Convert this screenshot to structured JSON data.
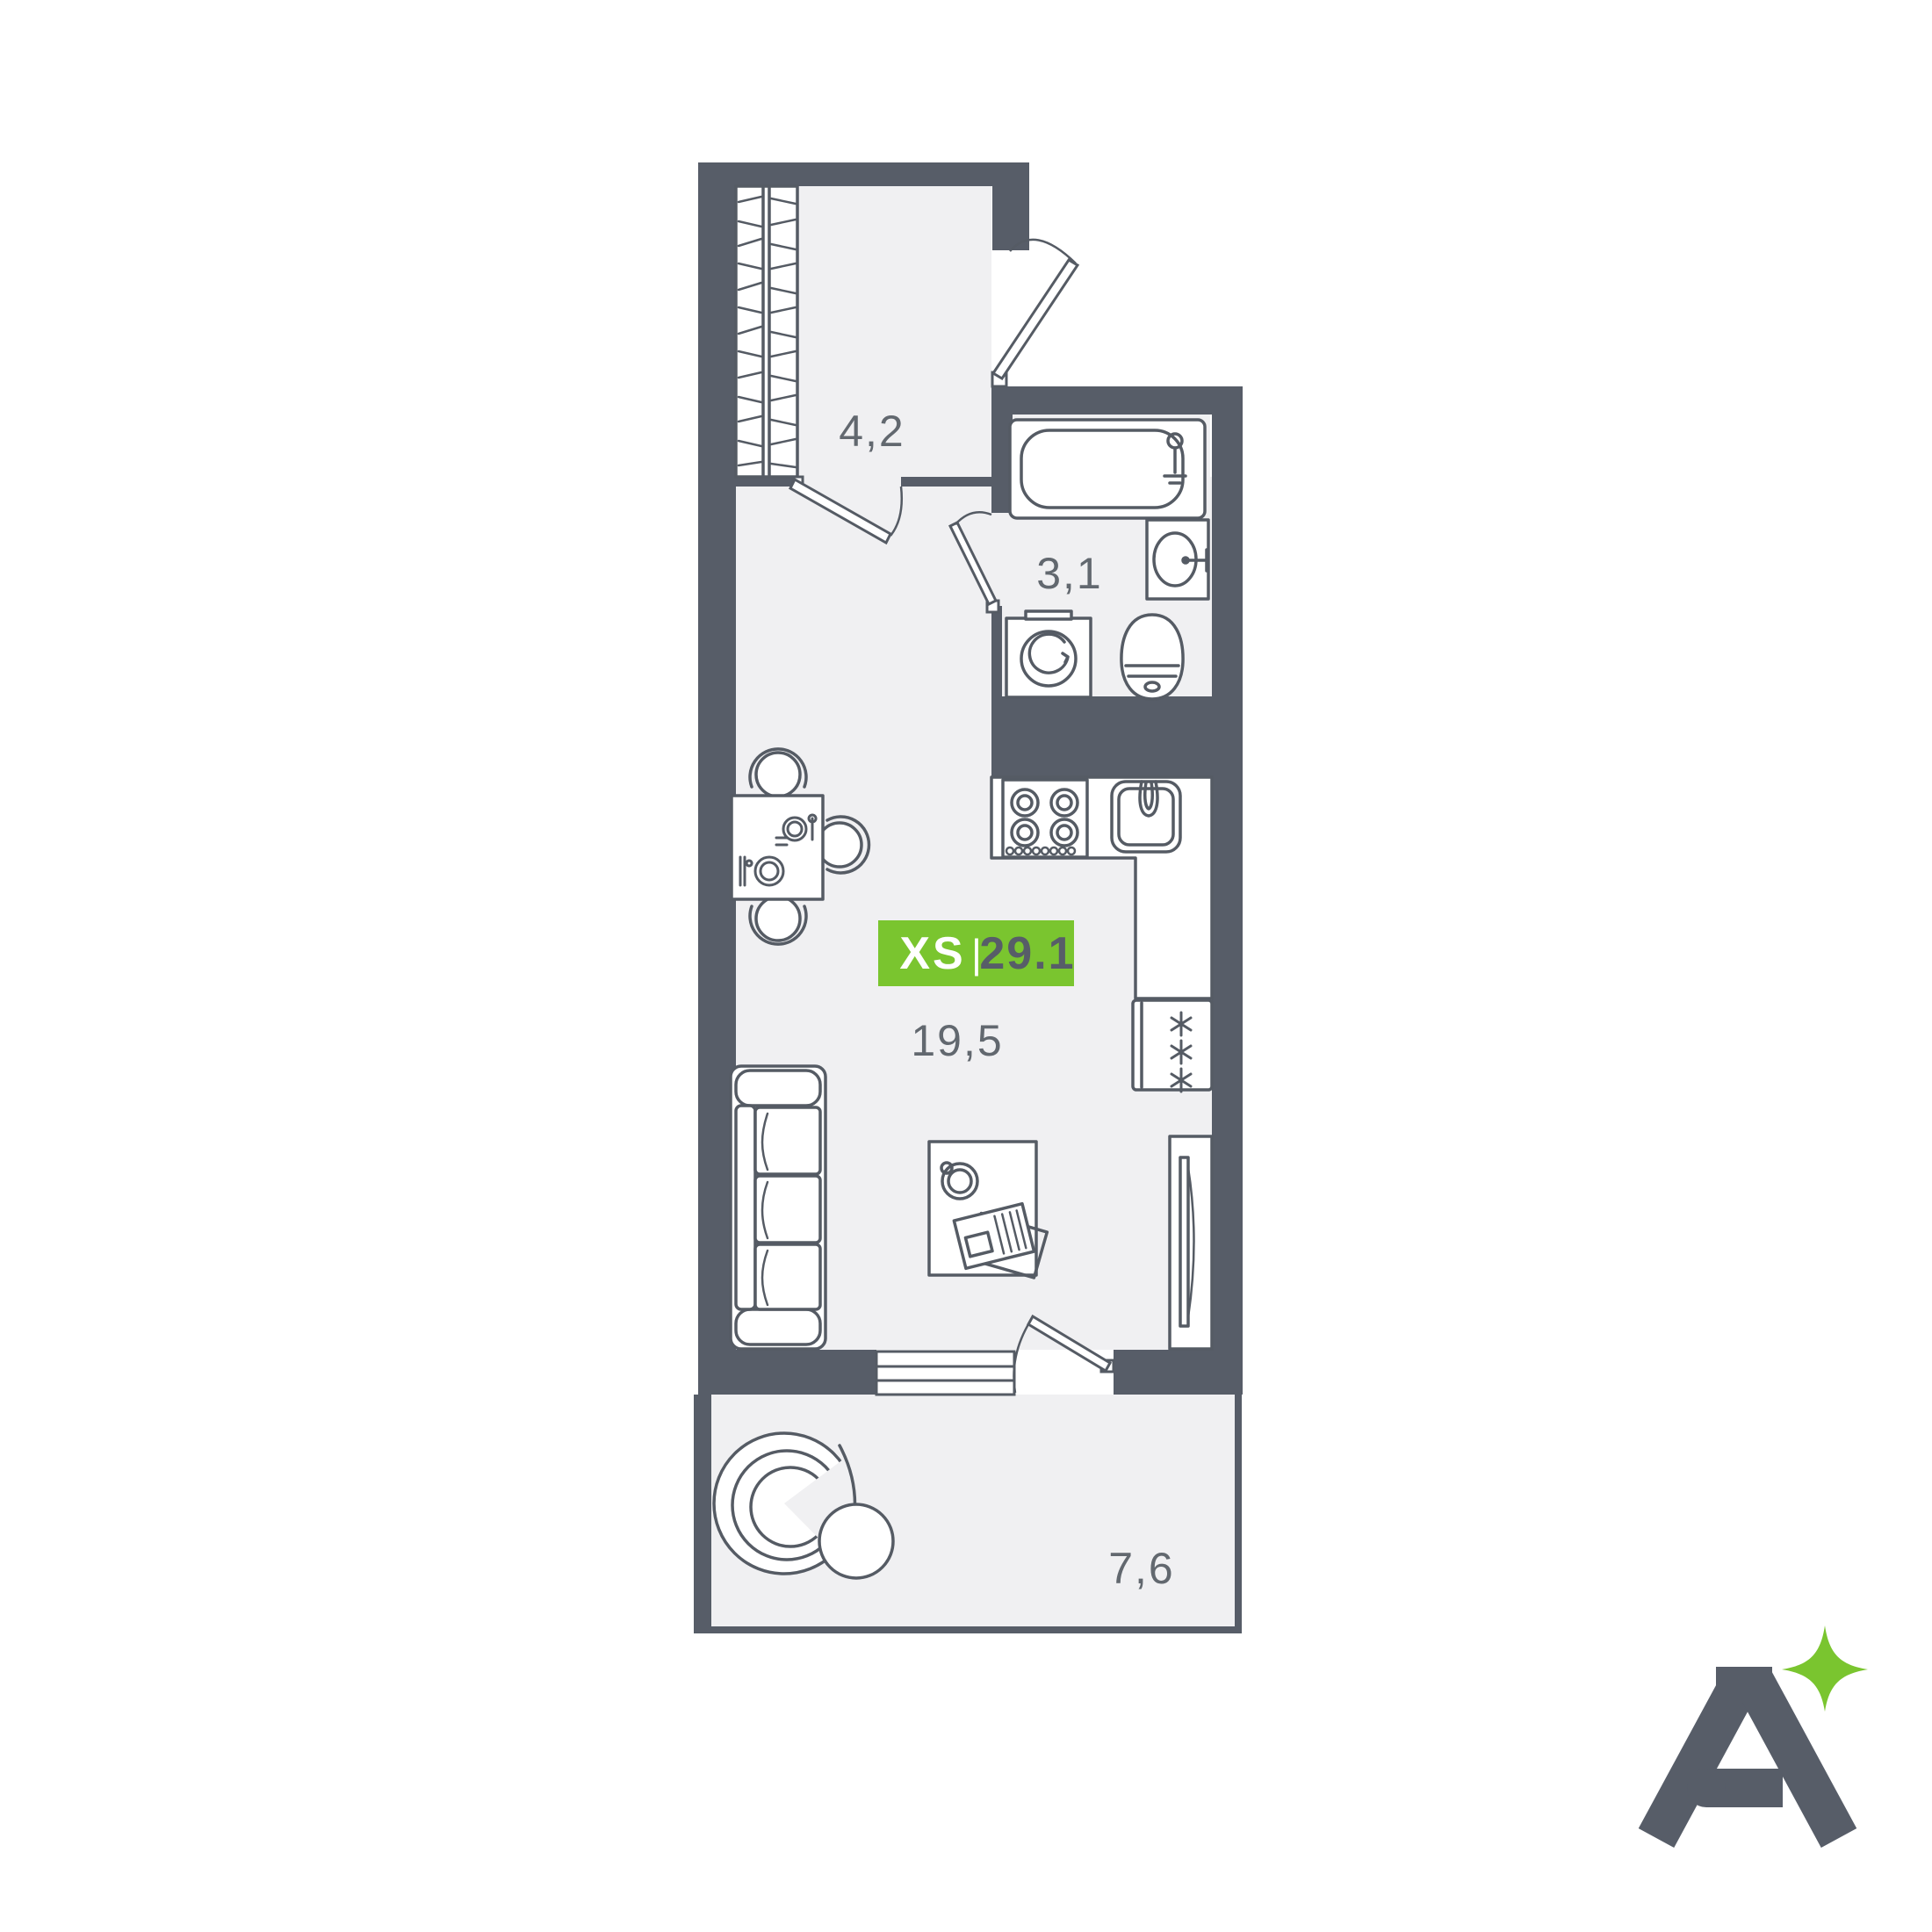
{
  "floor_plan": {
    "badge": {
      "size_label": "XS",
      "separator": "|",
      "area_total": "29.1"
    },
    "rooms": {
      "hallway": {
        "area_label": "4,2"
      },
      "bathroom": {
        "area_label": "3,1"
      },
      "living_kitchen": {
        "area_label": "19,5"
      },
      "balcony": {
        "area_label": "7,6"
      }
    }
  },
  "colors": {
    "wall": "#575D68",
    "floor": "#F0F0F2",
    "furniture_outline": "#555B64",
    "room_label": "#62686F",
    "badge_green": "#7AC52F",
    "badge_size_text": "#FFFFFF",
    "badge_area_text": "#575D68",
    "logo_gray": "#575D68",
    "logo_sparkle_green": "#7AC52F"
  }
}
